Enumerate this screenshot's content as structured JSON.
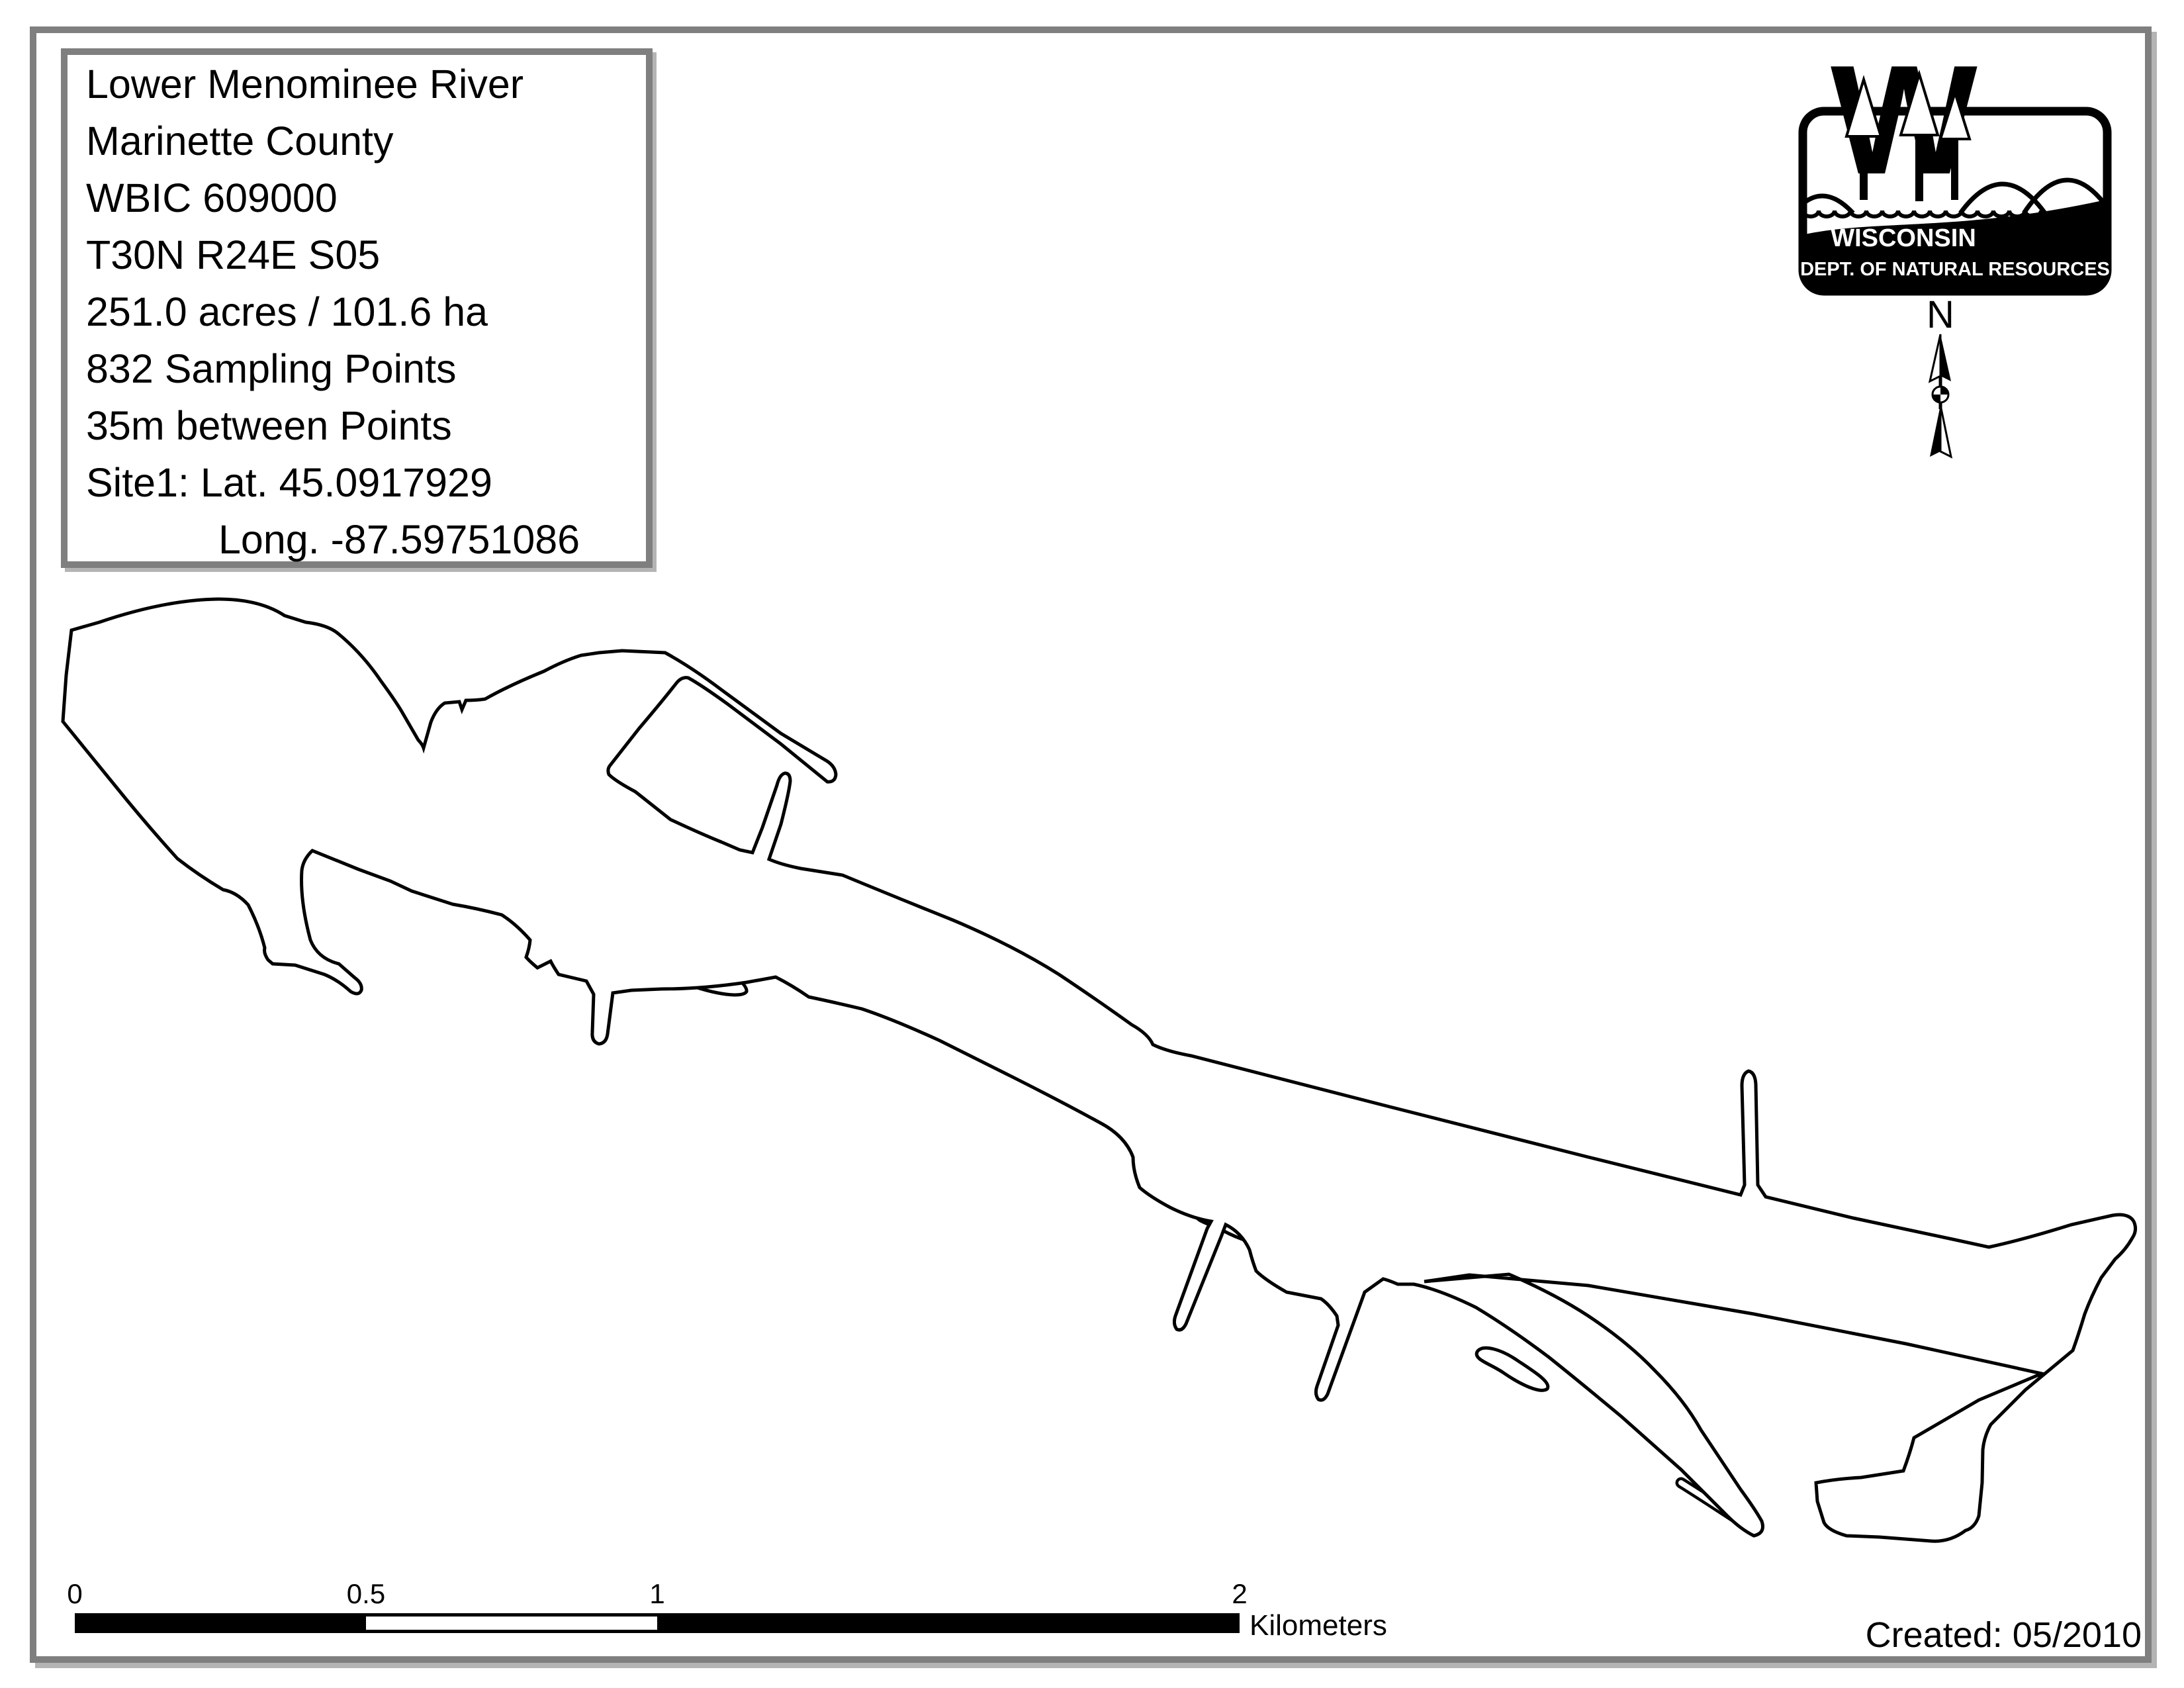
{
  "info_box": {
    "lines": [
      "Lower Menominee River",
      "Marinette County",
      "WBIC 609000",
      "T30N R24E S05",
      "251.0 acres / 101.6 ha",
      "832 Sampling Points",
      "35m between Points",
      "Site1: Lat. 45.0917929",
      "Long. -87.59751086"
    ]
  },
  "logo": {
    "emblem_letter": "W",
    "line1": "WISCONSIN",
    "line2": "DEPT. OF NATURAL RESOURCES"
  },
  "north_arrow": {
    "label": "N"
  },
  "scale_bar": {
    "ticks": [
      "0",
      "0.5",
      "1",
      "2"
    ],
    "unit": "Kilometers"
  },
  "created": "Created: 05/2010",
  "colors": {
    "ink": "#000000",
    "frame_gray": "#7f7f7f",
    "shadow_gray": "#b4b4b4",
    "paper": "#ffffff"
  }
}
